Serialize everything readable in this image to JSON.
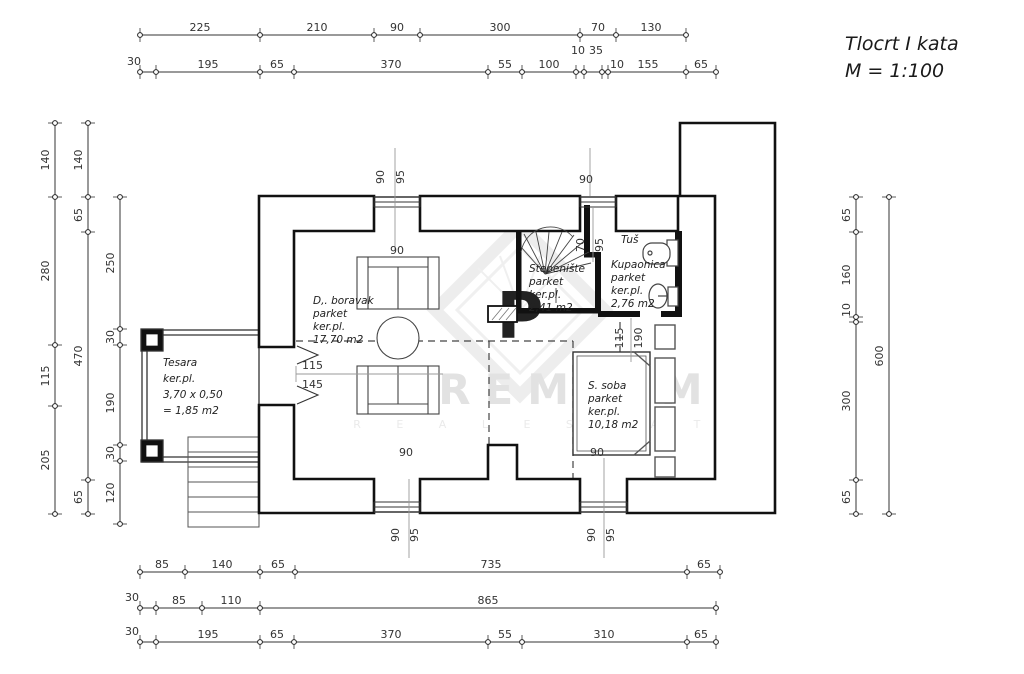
{
  "title": {
    "line1": "Tlocrt I kata",
    "line2": "M = 1:100"
  },
  "watermark": {
    "text": "PREMIUM",
    "sub": "R E A L E S T A T E",
    "logo_letter": "P"
  },
  "rooms": {
    "living": {
      "l1": "D,. boravak",
      "l2": "parket",
      "l3": "ker.pl.",
      "l4": "17,70 m2"
    },
    "stairs": {
      "l1": "Stepenište",
      "l2": "parket",
      "l3": "ker.pl.",
      "l4": "2,41 m2"
    },
    "bath": {
      "tus": "Tuš",
      "l1": "Kupaonica",
      "l2": "parket",
      "l3": "ker.pl.",
      "l4": "2,76 m2"
    },
    "bedroom": {
      "l1": "S. soba",
      "l2": "parket",
      "l3": "ker.pl.",
      "l4": "10,18 m2"
    },
    "terrace": {
      "l1": "Tesara",
      "l2": "ker.pl.",
      "l3": "3,70 x 0,50",
      "l4": "= 1,85 m2"
    }
  },
  "dims": {
    "top1": [
      "225",
      "210",
      "90",
      "300",
      "70",
      "130"
    ],
    "top2": [
      "30",
      "195",
      "65",
      "370",
      "55",
      "100",
      "10",
      "35",
      "10",
      "155",
      "65"
    ],
    "left1": [
      "140",
      "280",
      "115",
      "205"
    ],
    "left2": [
      "140",
      "65",
      "470",
      "65"
    ],
    "left3": [
      "250",
      "30",
      "190",
      "30",
      "120"
    ],
    "right1": [
      "65",
      "160",
      "10",
      "300",
      "65"
    ],
    "right2": [
      "600"
    ],
    "bottom1": [
      "85",
      "140",
      "65",
      "735",
      "65"
    ],
    "bottom2": [
      "30",
      "85",
      "110",
      "865"
    ],
    "bottom3": [
      "30",
      "195",
      "65",
      "370",
      "55",
      "310",
      "65"
    ]
  },
  "annotations": {
    "win1_top_w": "90",
    "win1_top_pair": [
      "90",
      "95"
    ],
    "win2_top_w": "90",
    "stair_pair": [
      "70",
      "95"
    ],
    "win1_bot_w": "90",
    "win1_bot_pair": [
      "90",
      "95"
    ],
    "win2_bot_w": "90",
    "win2_bot_pair": [
      "90",
      "95"
    ],
    "bed_pair": [
      "115",
      "190"
    ],
    "terrace_door": [
      "115",
      "145"
    ]
  }
}
